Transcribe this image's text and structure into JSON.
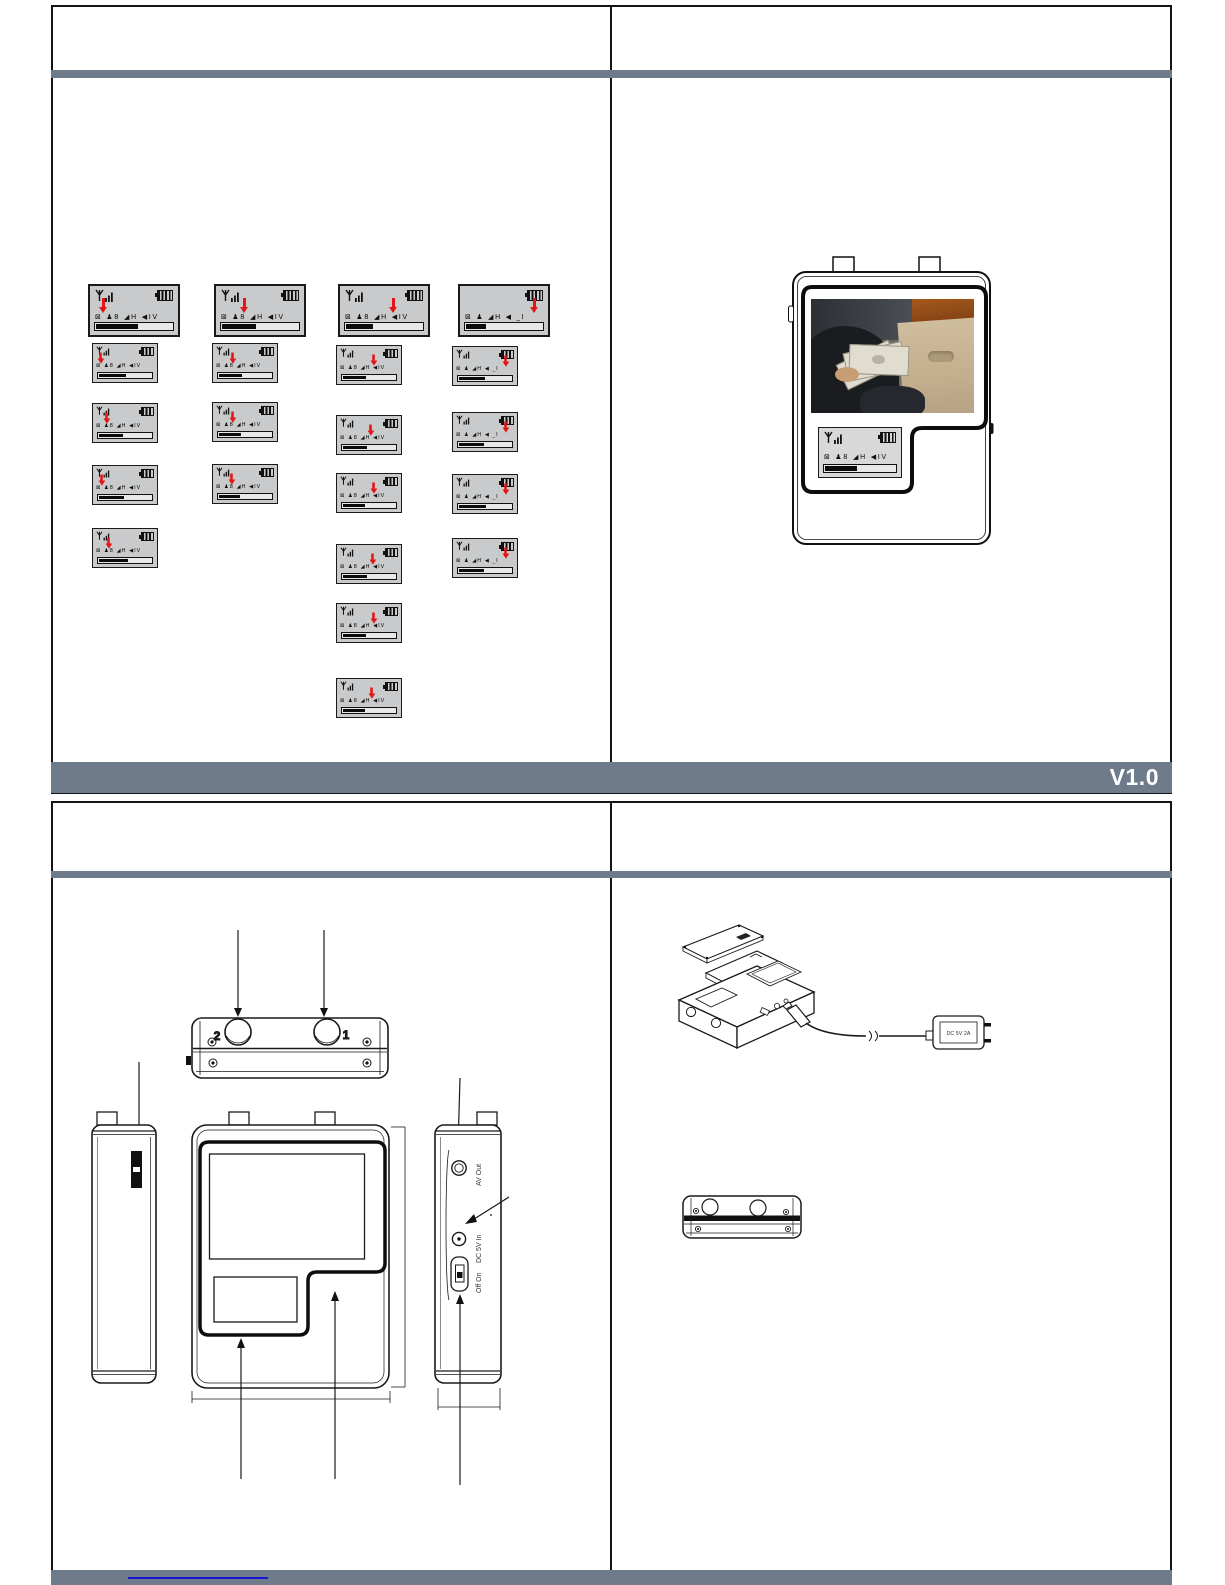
{
  "page1": {
    "footer": {
      "version": "V1.0"
    }
  },
  "page2": {
    "top_view": {
      "label_left": "2",
      "label_right": "1"
    },
    "right_view_labels": {
      "av_out": "AV Out",
      "dc_in": "DC 5V In",
      "power": "Off  On"
    },
    "adapter_label": "DC 5V 2A"
  },
  "colors": {
    "band_slate": "#6e7b8a",
    "page_border": "#141414",
    "arrow_red": "#e31515",
    "panel_gray": "#c9cacb",
    "link_blue": "#1717d6"
  },
  "lcd": {
    "icon_row_default": "⊠ ♟8 ◢H ◀ĪV",
    "icon_row_alt": "⊠ ♟ ◢H ◀ _Ī",
    "panels": [
      {
        "x": 88,
        "y": 284,
        "kind": "lg",
        "arrow": 0.17,
        "fill": 0.55,
        "antenna": true,
        "alt": false
      },
      {
        "x": 214,
        "y": 284,
        "kind": "lg",
        "arrow": 0.34,
        "fill": 0.45,
        "antenna": true,
        "alt": false
      },
      {
        "x": 338,
        "y": 284,
        "kind": "lg",
        "arrow": 0.62,
        "fill": 0.36,
        "antenna": true,
        "alt": false
      },
      {
        "x": 458,
        "y": 284,
        "kind": "lg",
        "arrow": 0.86,
        "fill": 0.26,
        "antenna": false,
        "alt": true
      },
      {
        "x": 92,
        "y": 343,
        "kind": "sm",
        "arrow": 0.14,
        "fill": 0.52,
        "antenna": true,
        "alt": false
      },
      {
        "x": 92,
        "y": 403,
        "kind": "sm",
        "arrow": 0.24,
        "fill": 0.46,
        "antenna": true,
        "alt": false
      },
      {
        "x": 92,
        "y": 465,
        "kind": "sm",
        "arrow": 0.16,
        "fill": 0.48,
        "antenna": true,
        "alt": false
      },
      {
        "x": 92,
        "y": 528,
        "kind": "sm",
        "arrow": 0.26,
        "fill": 0.55,
        "antenna": true,
        "alt": false
      },
      {
        "x": 212,
        "y": 343,
        "kind": "sm",
        "arrow": 0.33,
        "fill": 0.45,
        "antenna": true,
        "alt": false
      },
      {
        "x": 212,
        "y": 402,
        "kind": "sm",
        "arrow": 0.33,
        "fill": 0.42,
        "antenna": true,
        "alt": false
      },
      {
        "x": 212,
        "y": 464,
        "kind": "sm",
        "arrow": 0.31,
        "fill": 0.4,
        "antenna": true,
        "alt": false
      },
      {
        "x": 336,
        "y": 345,
        "kind": "sm",
        "arrow": 0.6,
        "fill": 0.44,
        "antenna": true,
        "alt": false
      },
      {
        "x": 336,
        "y": 415,
        "kind": "sm",
        "arrow": 0.55,
        "fill": 0.46,
        "antenna": true,
        "alt": false
      },
      {
        "x": 336,
        "y": 473,
        "kind": "sm",
        "arrow": 0.6,
        "fill": 0.42,
        "antenna": true,
        "alt": false
      },
      {
        "x": 336,
        "y": 544,
        "kind": "sm",
        "arrow": 0.58,
        "fill": 0.46,
        "antenna": true,
        "alt": false
      },
      {
        "x": 336,
        "y": 603,
        "kind": "sm",
        "arrow": 0.6,
        "fill": 0.44,
        "antenna": true,
        "alt": false
      },
      {
        "x": 336,
        "y": 678,
        "kind": "sm",
        "arrow": 0.56,
        "fill": 0.42,
        "antenna": true,
        "alt": false
      },
      {
        "x": 452,
        "y": 346,
        "kind": "sm",
        "arrow": 0.85,
        "fill": 0.5,
        "antenna": true,
        "alt": true
      },
      {
        "x": 452,
        "y": 412,
        "kind": "sm",
        "arrow": 0.85,
        "fill": 0.48,
        "antenna": true,
        "alt": true
      },
      {
        "x": 452,
        "y": 474,
        "kind": "sm",
        "arrow": 0.85,
        "fill": 0.52,
        "antenna": true,
        "alt": true
      },
      {
        "x": 452,
        "y": 538,
        "kind": "sm",
        "arrow": 0.85,
        "fill": 0.48,
        "antenna": true,
        "alt": true
      },
      {
        "x": 818,
        "y": 427,
        "kind": "dev",
        "arrow": null,
        "fill": 0.45,
        "antenna": true,
        "alt": false
      }
    ]
  }
}
